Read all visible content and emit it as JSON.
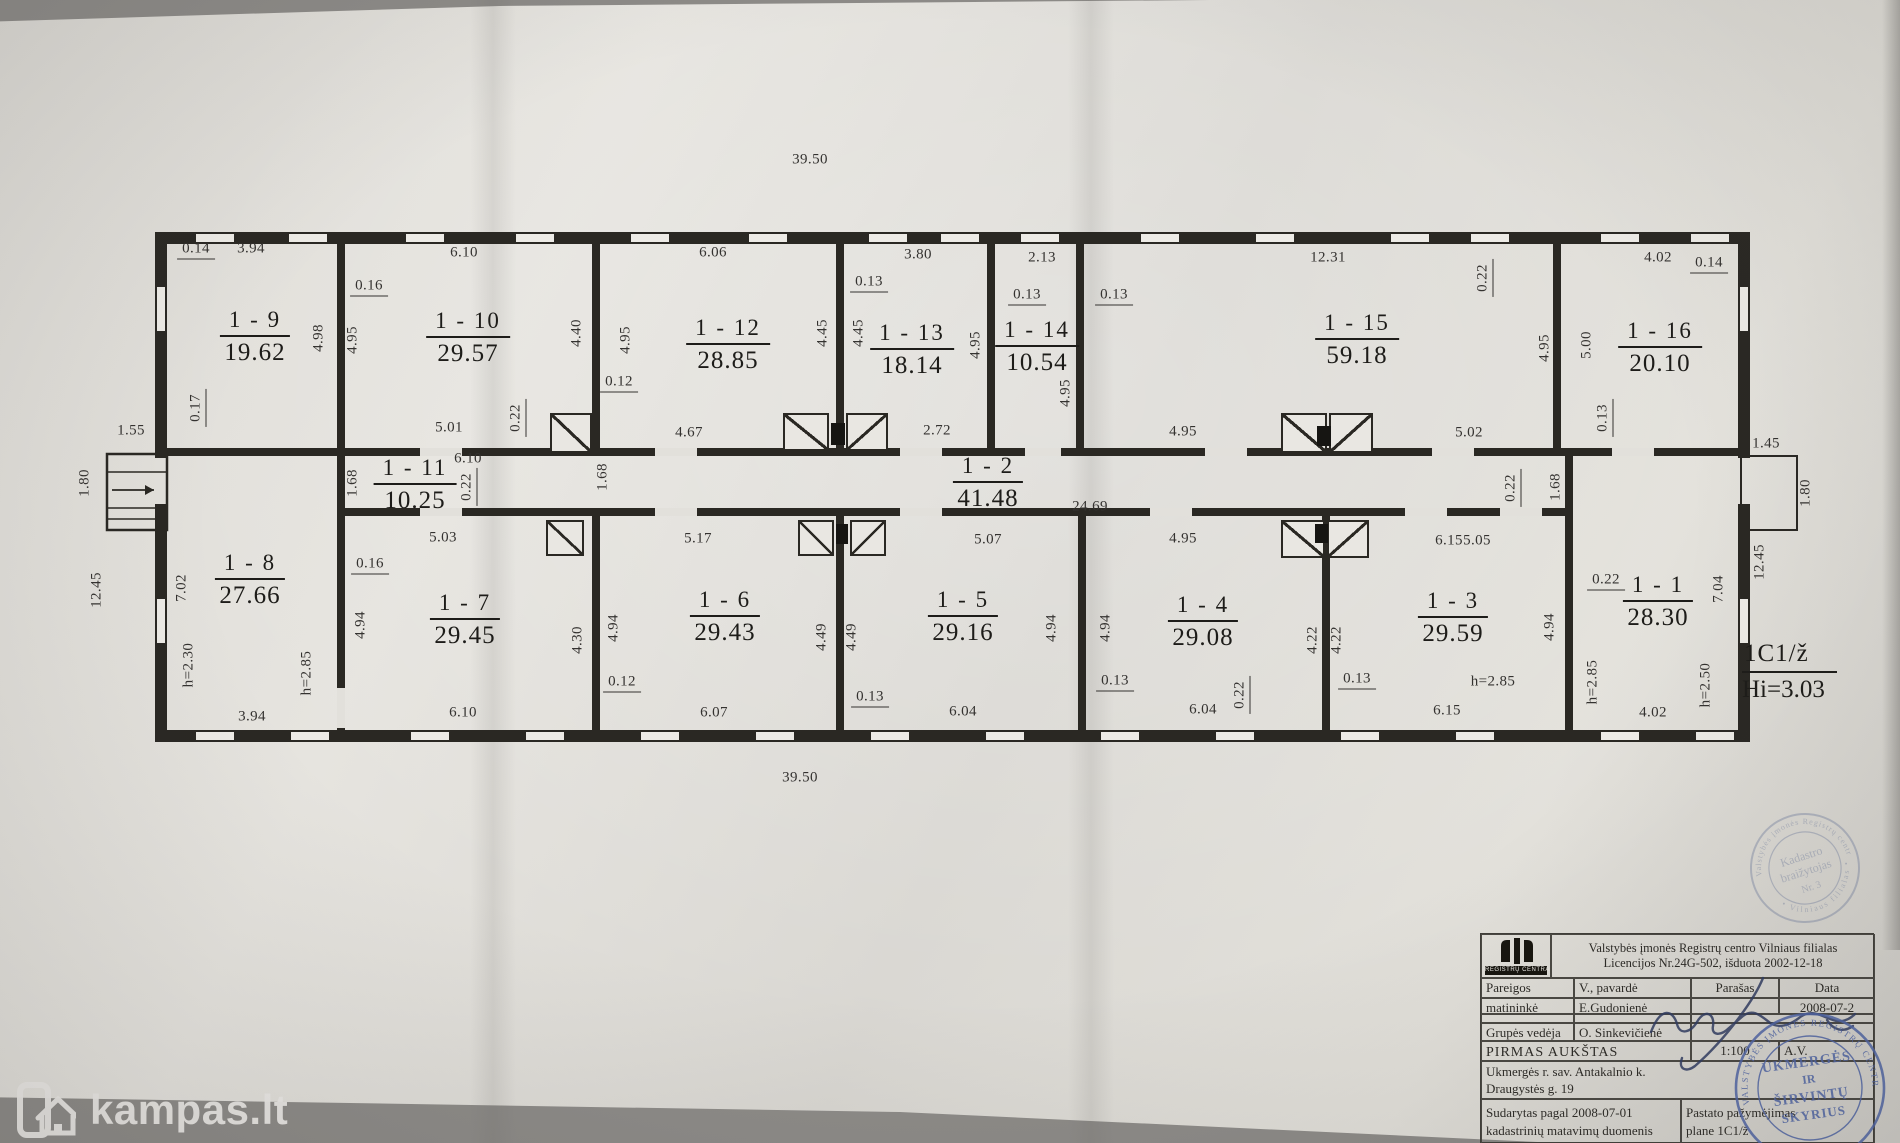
{
  "watermark": {
    "text": "kampas.lt"
  },
  "plan": {
    "unit_code": "1C1/ž",
    "unit_height": "Hi=3.03",
    "rooms": [
      {
        "id": "1 - 9",
        "area": "19.62",
        "x": 255,
        "y": 337
      },
      {
        "id": "1 - 10",
        "area": "29.57",
        "x": 468,
        "y": 338
      },
      {
        "id": "1 - 12",
        "area": "28.85",
        "x": 728,
        "y": 345
      },
      {
        "id": "1 - 13",
        "area": "18.14",
        "x": 912,
        "y": 350
      },
      {
        "id": "1 - 14",
        "area": "10.54",
        "x": 1037,
        "y": 347
      },
      {
        "id": "1 - 15",
        "area": "59.18",
        "x": 1357,
        "y": 340
      },
      {
        "id": "1 - 16",
        "area": "20.10",
        "x": 1660,
        "y": 348
      },
      {
        "id": "1 - 11",
        "area": "10.25",
        "x": 415,
        "y": 485
      },
      {
        "id": "1 - 2",
        "area": "41.48",
        "x": 988,
        "y": 483
      },
      {
        "id": "1 - 8",
        "area": "27.66",
        "x": 250,
        "y": 580
      },
      {
        "id": "1 - 7",
        "area": "29.45",
        "x": 465,
        "y": 620
      },
      {
        "id": "1 - 6",
        "area": "29.43",
        "x": 725,
        "y": 617
      },
      {
        "id": "1 - 5",
        "area": "29.16",
        "x": 963,
        "y": 617
      },
      {
        "id": "1 - 4",
        "area": "29.08",
        "x": 1203,
        "y": 622
      },
      {
        "id": "1 - 3",
        "area": "29.59",
        "x": 1453,
        "y": 618
      },
      {
        "id": "1 - 1",
        "area": "28.30",
        "x": 1658,
        "y": 602
      }
    ],
    "dims": [
      {
        "t": "39.50",
        "x": 810,
        "y": 160
      },
      {
        "t": "0.14",
        "x": 196,
        "y": 250
      },
      {
        "t": "3.94",
        "x": 251,
        "y": 249
      },
      {
        "t": "6.10",
        "x": 464,
        "y": 253
      },
      {
        "t": "6.06",
        "x": 713,
        "y": 253
      },
      {
        "t": "3.80",
        "x": 918,
        "y": 255
      },
      {
        "t": "2.13",
        "x": 1042,
        "y": 258
      },
      {
        "t": "12.31",
        "x": 1328,
        "y": 258
      },
      {
        "t": "4.02",
        "x": 1658,
        "y": 258
      },
      {
        "t": "0.14",
        "x": 1709,
        "y": 264
      },
      {
        "t": "0.16",
        "x": 369,
        "y": 287
      },
      {
        "t": "0.13",
        "x": 869,
        "y": 283
      },
      {
        "t": "0.13",
        "x": 1027,
        "y": 296
      },
      {
        "t": "0.13",
        "x": 1114,
        "y": 296
      },
      {
        "t": "0.22",
        "x": 1484,
        "y": 278,
        "r": 1
      },
      {
        "t": "4.98",
        "x": 319,
        "y": 338,
        "r": 1
      },
      {
        "t": "4.95",
        "x": 353,
        "y": 340,
        "r": 1
      },
      {
        "t": "4.40",
        "x": 577,
        "y": 333,
        "r": 1
      },
      {
        "t": "4.95",
        "x": 626,
        "y": 340,
        "r": 1
      },
      {
        "t": "4.45",
        "x": 823,
        "y": 333,
        "r": 1
      },
      {
        "t": "4.45",
        "x": 859,
        "y": 333,
        "r": 1
      },
      {
        "t": "4.95",
        "x": 976,
        "y": 345,
        "r": 1
      },
      {
        "t": "4.95",
        "x": 1066,
        "y": 393,
        "r": 1
      },
      {
        "t": "4.95",
        "x": 1545,
        "y": 348,
        "r": 1
      },
      {
        "t": "5.00",
        "x": 1587,
        "y": 345,
        "r": 1
      },
      {
        "t": "0.12",
        "x": 619,
        "y": 383
      },
      {
        "t": "0.17",
        "x": 197,
        "y": 408,
        "r": 1
      },
      {
        "t": "5.01",
        "x": 449,
        "y": 428
      },
      {
        "t": "0.22",
        "x": 517,
        "y": 418,
        "r": 1
      },
      {
        "t": "4.67",
        "x": 689,
        "y": 433
      },
      {
        "t": "2.72",
        "x": 937,
        "y": 431
      },
      {
        "t": "4.95",
        "x": 1183,
        "y": 432
      },
      {
        "t": "5.02",
        "x": 1469,
        "y": 433
      },
      {
        "t": "6.10",
        "x": 468,
        "y": 459
      },
      {
        "t": "1.68",
        "x": 353,
        "y": 483,
        "r": 1
      },
      {
        "t": "0.22",
        "x": 468,
        "y": 487,
        "r": 1
      },
      {
        "t": "1.68",
        "x": 603,
        "y": 477,
        "r": 1
      },
      {
        "t": "24.69",
        "x": 1090,
        "y": 507
      },
      {
        "t": "1.68",
        "x": 1556,
        "y": 487,
        "r": 1
      },
      {
        "t": "0.22",
        "x": 1512,
        "y": 488,
        "r": 1
      },
      {
        "t": "0.13",
        "x": 1604,
        "y": 418,
        "r": 1
      },
      {
        "t": "1.55",
        "x": 131,
        "y": 431
      },
      {
        "t": "1.80",
        "x": 85,
        "y": 483,
        "r": 1
      },
      {
        "t": "12.45",
        "x": 97,
        "y": 590,
        "r": 1
      },
      {
        "t": "7.02",
        "x": 182,
        "y": 588,
        "r": 1
      },
      {
        "t": "h=2.30",
        "x": 189,
        "y": 665,
        "r": 1
      },
      {
        "t": "h=2.85",
        "x": 307,
        "y": 673,
        "r": 1
      },
      {
        "t": "3.94",
        "x": 252,
        "y": 717
      },
      {
        "t": "5.03",
        "x": 443,
        "y": 538
      },
      {
        "t": "0.16",
        "x": 370,
        "y": 565
      },
      {
        "t": "4.94",
        "x": 361,
        "y": 625,
        "r": 1
      },
      {
        "t": "6.10",
        "x": 463,
        "y": 713
      },
      {
        "t": "5.17",
        "x": 698,
        "y": 539
      },
      {
        "t": "5.07",
        "x": 988,
        "y": 540
      },
      {
        "t": "4.30",
        "x": 578,
        "y": 640,
        "r": 1
      },
      {
        "t": "4.94",
        "x": 614,
        "y": 628,
        "r": 1
      },
      {
        "t": "4.49",
        "x": 822,
        "y": 637,
        "r": 1
      },
      {
        "t": "4.49",
        "x": 852,
        "y": 637,
        "r": 1
      },
      {
        "t": "4.94",
        "x": 1052,
        "y": 628,
        "r": 1
      },
      {
        "t": "0.12",
        "x": 622,
        "y": 683
      },
      {
        "t": "0.13",
        "x": 870,
        "y": 698
      },
      {
        "t": "6.07",
        "x": 714,
        "y": 713
      },
      {
        "t": "6.04",
        "x": 963,
        "y": 712
      },
      {
        "t": "4.95",
        "x": 1183,
        "y": 539
      },
      {
        "t": "6.15",
        "x": 1449,
        "y": 541
      },
      {
        "t": "5.05",
        "x": 1477,
        "y": 541
      },
      {
        "t": "4.94",
        "x": 1106,
        "y": 628,
        "r": 1
      },
      {
        "t": "4.22",
        "x": 1313,
        "y": 640,
        "r": 1
      },
      {
        "t": "4.22",
        "x": 1337,
        "y": 640,
        "r": 1
      },
      {
        "t": "0.13",
        "x": 1115,
        "y": 682
      },
      {
        "t": "0.13",
        "x": 1357,
        "y": 680
      },
      {
        "t": "0.22",
        "x": 1241,
        "y": 695,
        "r": 1
      },
      {
        "t": "6.04",
        "x": 1203,
        "y": 710
      },
      {
        "t": "6.15",
        "x": 1447,
        "y": 711
      },
      {
        "t": "h=2.85",
        "x": 1493,
        "y": 682
      },
      {
        "t": "0.22",
        "x": 1606,
        "y": 581
      },
      {
        "t": "4.94",
        "x": 1550,
        "y": 627,
        "r": 1
      },
      {
        "t": "7.04",
        "x": 1719,
        "y": 589,
        "r": 1
      },
      {
        "t": "12.45",
        "x": 1760,
        "y": 562,
        "r": 1
      },
      {
        "t": "h=2.85",
        "x": 1593,
        "y": 682,
        "r": 1
      },
      {
        "t": "h=2.50",
        "x": 1706,
        "y": 685,
        "r": 1
      },
      {
        "t": "4.02",
        "x": 1653,
        "y": 713
      },
      {
        "t": "1.45",
        "x": 1766,
        "y": 444
      },
      {
        "t": "1.80",
        "x": 1806,
        "y": 493,
        "r": 1
      },
      {
        "t": "39.50",
        "x": 800,
        "y": 778
      }
    ]
  },
  "titleblock": {
    "logo_caption": "REGISTRŲ CENTRAS",
    "header_line1": "Valstybės įmonės Registrų centro  Vilniaus filialas",
    "header_line2": "Licencijos Nr.24G-502, išduota 2002-12-18",
    "col_pareigos": "Pareigos",
    "col_pavarde": "V., pavardė",
    "col_parasas": "Parašas",
    "col_data": "Data",
    "row1_role": "matininkė",
    "row1_name": "E.Gudonienė",
    "row1_date": "2008-07-2",
    "row2_role": "Grupės vedėja",
    "row2_name": "O. Sinkevičienė",
    "floor_label": "PIRMAS AUKŠTAS",
    "scale": "1:100",
    "av": "A.V.",
    "address_line1": "Ukmergės r. sav. Antakalnio k.",
    "address_line2": "Draugystės g. 19",
    "footer_left1": "Sudarytas pagal  2008-07-01",
    "footer_left2": "kadastrinių matavimų duomenis",
    "footer_right1": "Pastato pažymėjimas",
    "footer_right2": "plane    1C1/ž"
  },
  "stamps": {
    "kadastro": {
      "center1": "Kadastro",
      "center2": "braižytojas",
      "center3": "Nr. 3",
      "arc_top": "Valstybės įmonės Registrų centro",
      "arc_bottom": "• Vilniaus filialas •"
    },
    "ukmerge": {
      "center1": "UKMERGĖS",
      "center2": "IR",
      "center3": "ŠIRVINTŲ",
      "center4": "SKYRIUS",
      "arc": "VALSTYBĖS ĮMONĖS REGISTRŲ CENTRO • VILNIAUS FILIALAS •"
    }
  }
}
